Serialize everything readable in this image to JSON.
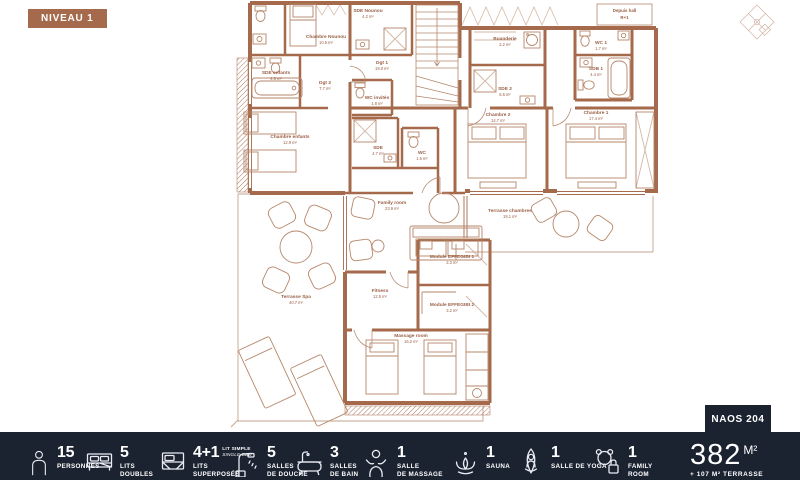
{
  "badge": {
    "label": "NIVEAU 1"
  },
  "unit_tab": {
    "label": "NAOS 204"
  },
  "plan": {
    "rooms": [
      {
        "name": "Chambre Nounou",
        "area": "10.5 m²"
      },
      {
        "name": "SDE Nounou",
        "area": "4.2 m²"
      },
      {
        "name": "SDE enfants",
        "area": "4.6 m²"
      },
      {
        "name": "Dgt 2",
        "area": "7.7 m²"
      },
      {
        "name": "Dgt 1",
        "area": "19.0 m²"
      },
      {
        "name": "WC invités",
        "area": "1.8 m²"
      },
      {
        "name": "Chambre enfants",
        "area": "12.9 m²"
      },
      {
        "name": "SDE",
        "area": "4.7 m²"
      },
      {
        "name": "WC",
        "area": "1.6 m²"
      },
      {
        "name": "Buanderie",
        "area": "2.2 m²"
      },
      {
        "name": "SDE 2",
        "area": "5.5 m²"
      },
      {
        "name": "WC 1",
        "area": "1.7 m²"
      },
      {
        "name": "SDB 1",
        "area": "4.4 m²"
      },
      {
        "name": "Chambre 2",
        "area": "14.7 m²"
      },
      {
        "name": "Chambre 1",
        "area": "17.4 m²"
      },
      {
        "name": "Terrasse chambres",
        "area": "19.1 m²"
      },
      {
        "name": "Family room",
        "area": "23.9 m²"
      },
      {
        "name": "Terrasse Spa",
        "area": "40.7 m²"
      },
      {
        "name": "Fitness",
        "area": "12.5 m²"
      },
      {
        "name": "Module EFFEGIBI 1",
        "area": "3.3 m²"
      },
      {
        "name": "Module EFFEGIBI 2",
        "area": "3.2 m²"
      },
      {
        "name": "Massage room",
        "area": "16.2 m²"
      }
    ],
    "hall_note": {
      "line1": "Depuis hall",
      "line2": "R+1"
    }
  },
  "footer": {
    "items": [
      {
        "icon": "person-icon",
        "count": "15",
        "label1": "PERSONNES",
        "label2": ""
      },
      {
        "icon": "double-bed-icon",
        "count": "5",
        "label1": "LITS",
        "label2": "DOUBLES"
      },
      {
        "icon": "bunk-bed-icon",
        "count": "4+1",
        "note_line1": "LIT SIMPLE",
        "note_line2": "SINGLE BED",
        "label1": "LITS",
        "label2": "SUPERPOSÉS"
      },
      {
        "icon": "shower-icon",
        "count": "5",
        "label1": "SALLES",
        "label2": "DE DOUCHE"
      },
      {
        "icon": "bathtub-icon",
        "count": "3",
        "label1": "SALLES",
        "label2": "DE BAIN"
      },
      {
        "icon": "massage-icon",
        "count": "1",
        "label1": "SALLE",
        "label2": "DE MASSAGE"
      },
      {
        "icon": "sauna-icon",
        "count": "1",
        "label1": "SAUNA",
        "label2": ""
      },
      {
        "icon": "yoga-icon",
        "count": "1",
        "label1": "SALLE DE YOGA",
        "label2": ""
      },
      {
        "icon": "family-icon",
        "count": "1",
        "label1": "FAMILY",
        "label2": "ROOM"
      }
    ],
    "area": {
      "value": "382",
      "unit": "M²",
      "terrace": "+ 107 M² TERRASSE"
    }
  },
  "colors": {
    "accent_brown": "#a5694b",
    "footer_bg": "#1b2230",
    "text_light": "#ffffff"
  }
}
